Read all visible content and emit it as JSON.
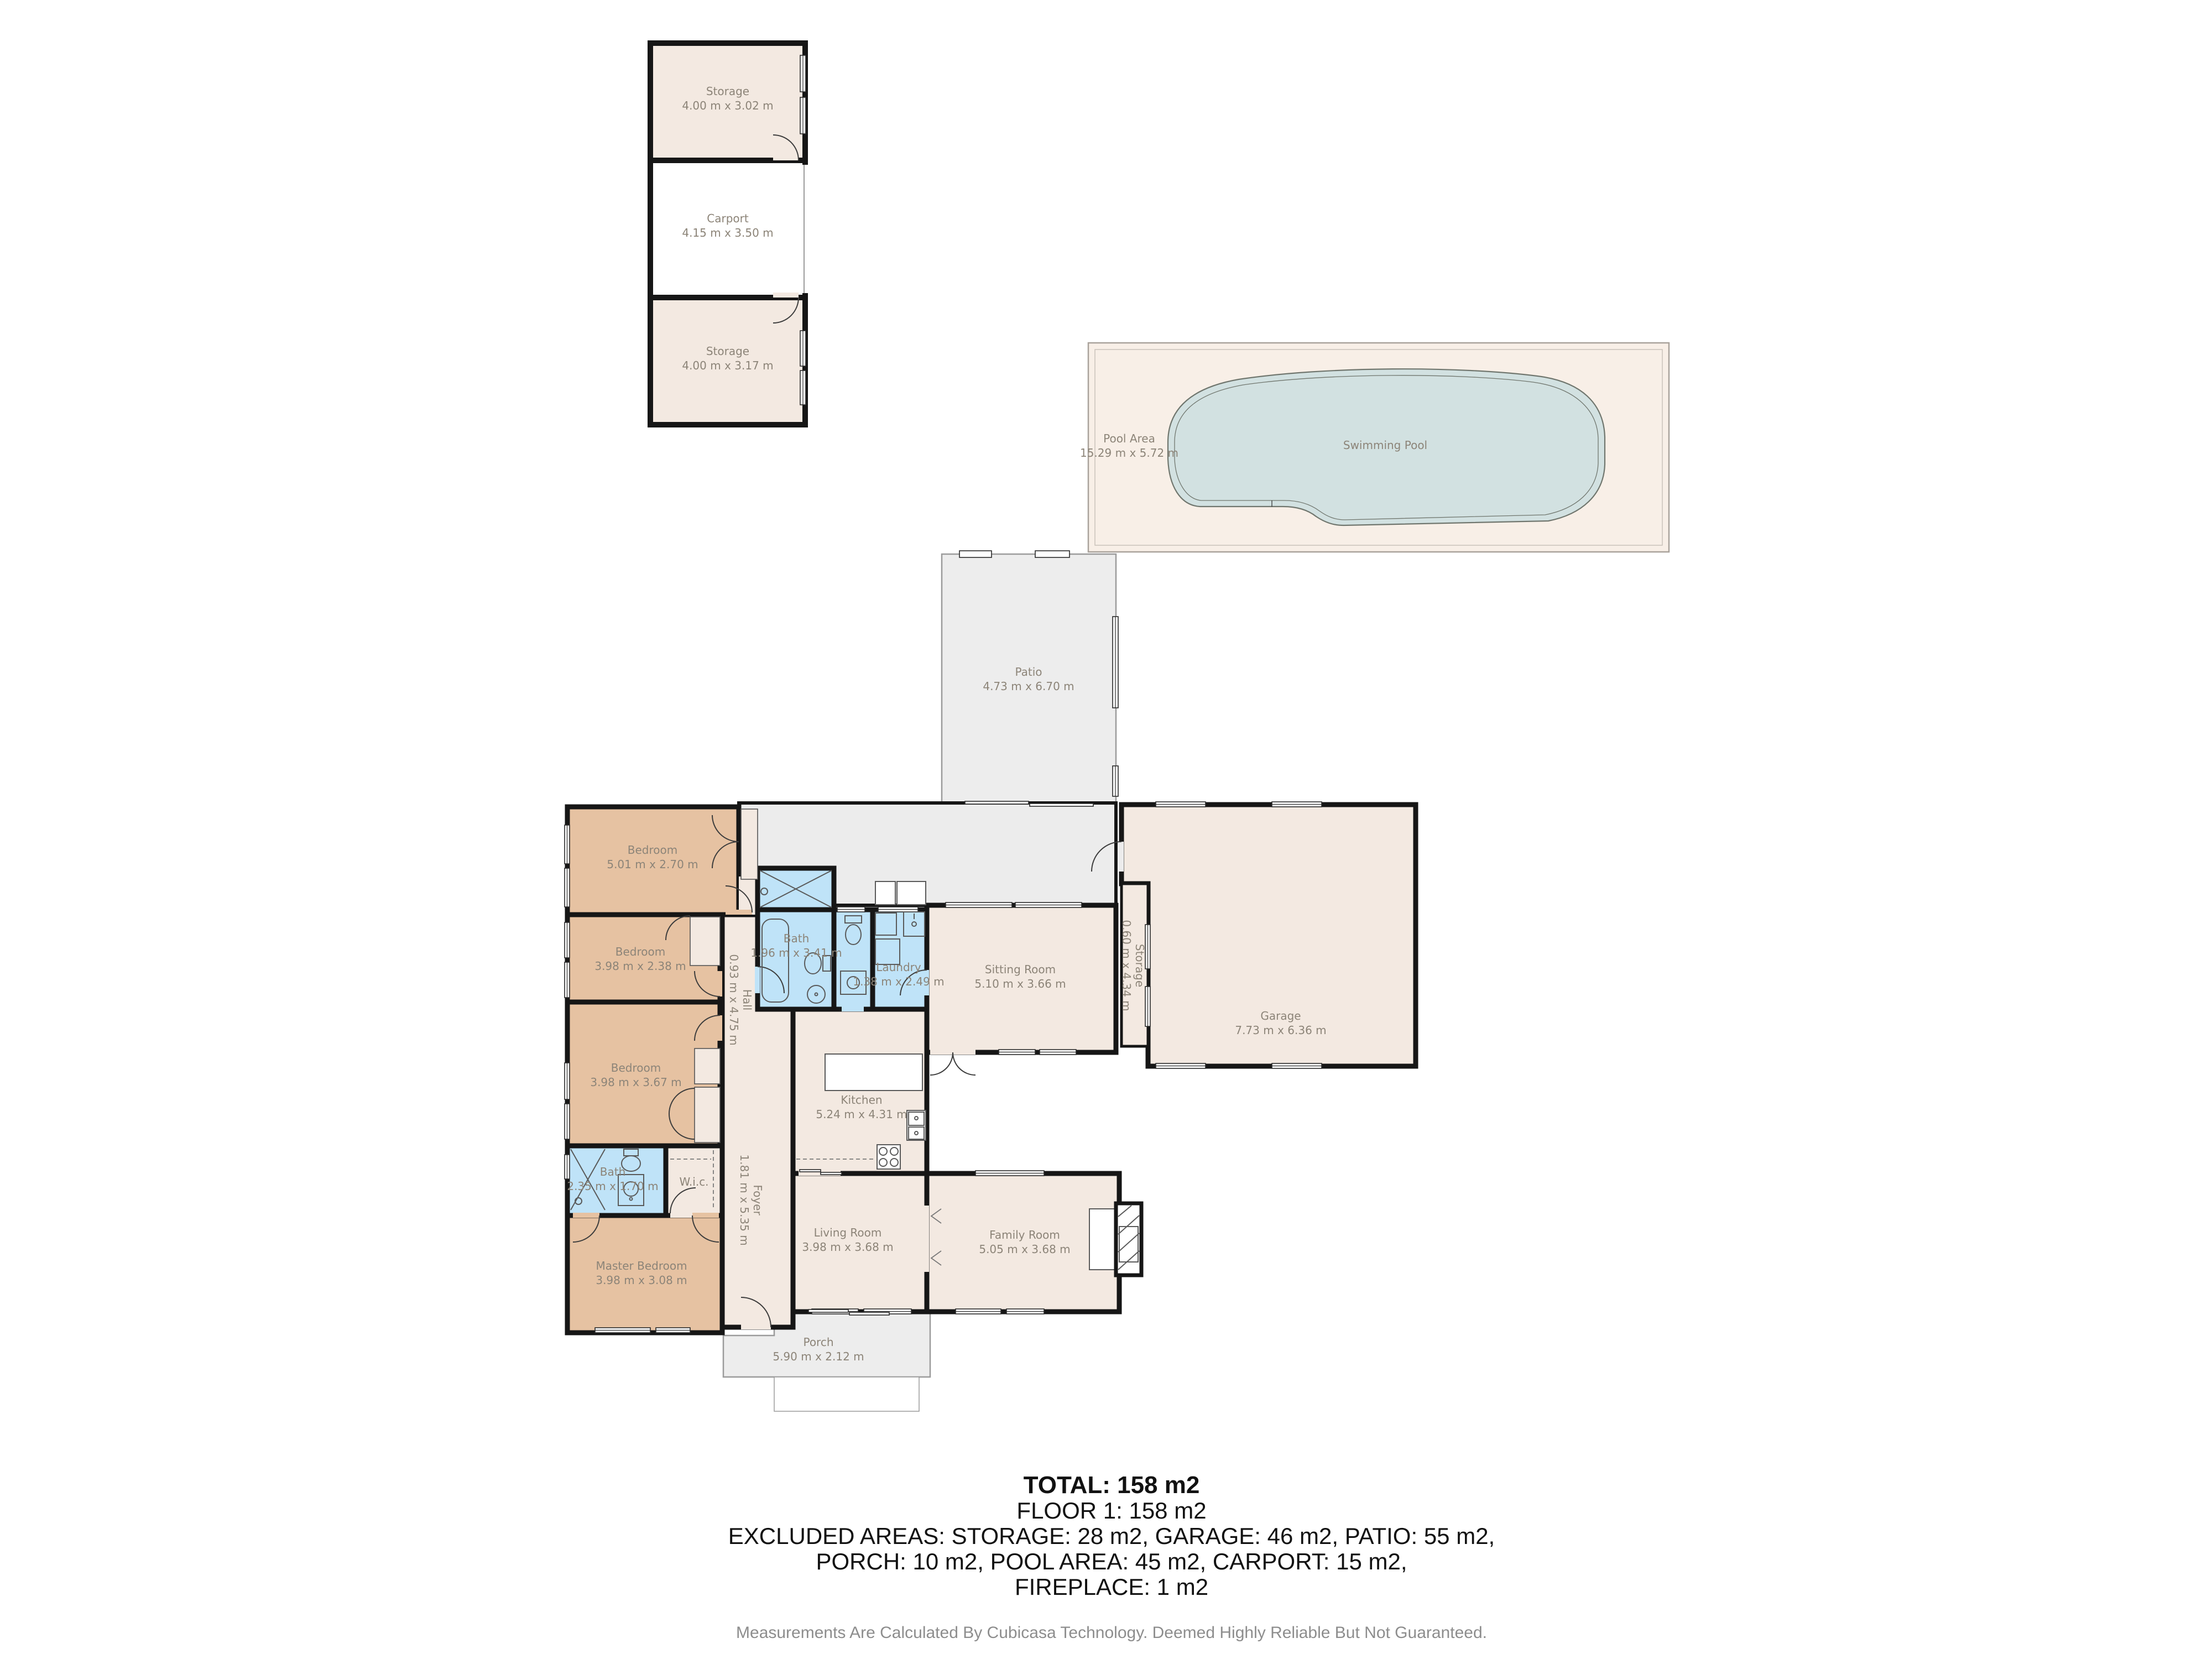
{
  "plan": {
    "outbuilding": {
      "storage_top": {
        "name": "Storage",
        "dims": "4.00 m x 3.02 m"
      },
      "carport": {
        "name": "Carport",
        "dims": "4.15 m x 3.50 m"
      },
      "storage_bottom": {
        "name": "Storage",
        "dims": "4.00 m x 3.17 m"
      }
    },
    "exterior": {
      "pool_area": {
        "name": "Pool Area",
        "dims": "15.29 m x 5.72 m"
      },
      "swimming_pool": {
        "name": "Swimming Pool"
      },
      "patio": {
        "name": "Patio",
        "dims": "4.73 m x 6.70 m"
      },
      "porch": {
        "name": "Porch",
        "dims": "5.90 m x 2.12 m"
      }
    },
    "rooms": {
      "bedroom_top": {
        "name": "Bedroom",
        "dims": "5.01 m x 2.70 m"
      },
      "bedroom_mid": {
        "name": "Bedroom",
        "dims": "3.98 m x 2.38 m"
      },
      "bedroom_lower": {
        "name": "Bedroom",
        "dims": "3.98 m x 3.67 m"
      },
      "master_bedroom": {
        "name": "Master Bedroom",
        "dims": "3.98 m x 3.08 m"
      },
      "hall": {
        "name": "Hall",
        "dims": "0.93 m x 4.75 m"
      },
      "foyer": {
        "name": "Foyer",
        "dims": "1.81 m x 5.35 m"
      },
      "bath_main": {
        "name": "Bath",
        "dims": "1.96 m x 3.41 m"
      },
      "bath_ensuite": {
        "name": "Bath",
        "dims": "2.35 m x 1.70 m"
      },
      "wic": {
        "name": "W.i.c."
      },
      "laundry": {
        "name": "Laundry",
        "dims": "1.38 m x 2.49 m"
      },
      "sitting_room": {
        "name": "Sitting Room",
        "dims": "5.10 m x 3.66 m"
      },
      "garage": {
        "name": "Garage",
        "dims": "7.73 m x 6.36 m"
      },
      "garage_storage": {
        "name": "Storage",
        "dims": "0.60 m x 4.34 m"
      },
      "kitchen": {
        "name": "Kitchen",
        "dims": "5.24 m x 4.31 m"
      },
      "living_room": {
        "name": "Living Room",
        "dims": "3.98 m x 3.68 m"
      },
      "family_room": {
        "name": "Family Room",
        "dims": "5.05 m x 3.68 m"
      }
    },
    "summary": {
      "total": "TOTAL: 158 m2",
      "floor": "FLOOR 1: 158 m2",
      "excluded_line1": "EXCLUDED AREAS: STORAGE: 28 m2, GARAGE: 46 m2, PATIO: 55 m2,",
      "excluded_line2": "PORCH: 10 m2, POOL AREA: 45 m2, CARPORT: 15 m2,",
      "excluded_line3": "FIREPLACE: 1 m2",
      "disclaimer": "Measurements Are Calculated By Cubicasa Technology. Deemed Highly Reliable But Not Guaranteed."
    },
    "colors": {
      "wall": "#161616",
      "bedroom_fill": "#e6c2a2",
      "wet_room_fill": "#bfe3f8",
      "room_fill": "#f3e9e1",
      "exterior_gray": "#ededed",
      "pool_deck": "#f8efe7",
      "pool_water": "#d2e1e1",
      "label_text": "#8c8478"
    }
  }
}
